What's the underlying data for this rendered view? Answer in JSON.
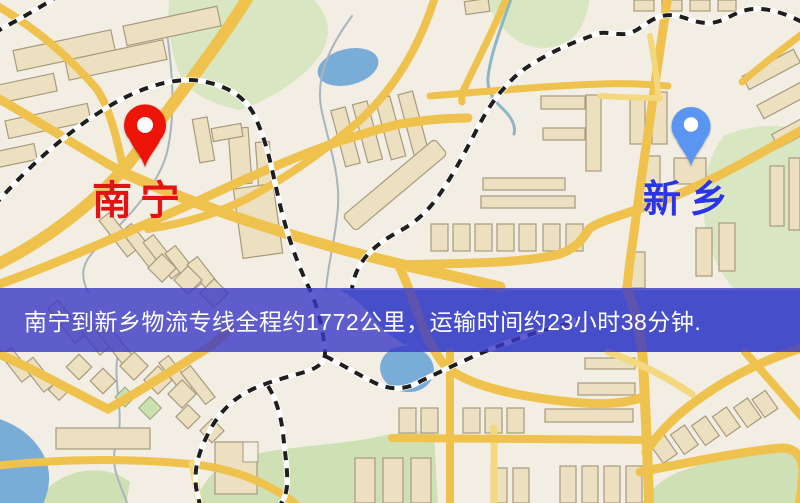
{
  "banner": {
    "text": "南宁到新乡物流专线全程约1772公里，运输时间约23小时38分钟.",
    "background": "rgba(58,56,198,0.8)",
    "text_color": "#ffffff"
  },
  "markers": {
    "origin": {
      "label": "南宁",
      "pin_color": "#ee1408",
      "label_color": "#e41313"
    },
    "destination": {
      "label": "新乡",
      "pin_color": "#5b95f2",
      "label_color": "#2a35e6"
    }
  },
  "map": {
    "background_color": "#f3eee3",
    "road_color": "#efc24d",
    "minor_road_color": "#f3d87e",
    "park_color": "#d8e6c2",
    "park_color_dark": "#cfe0b4",
    "water_color": "#7aacd8",
    "building_color": "#ece0c0",
    "building_outline_color": "#a89a7e",
    "railway_dash_color": "#1e1e1e",
    "railway_base_color": "#ffffff"
  }
}
